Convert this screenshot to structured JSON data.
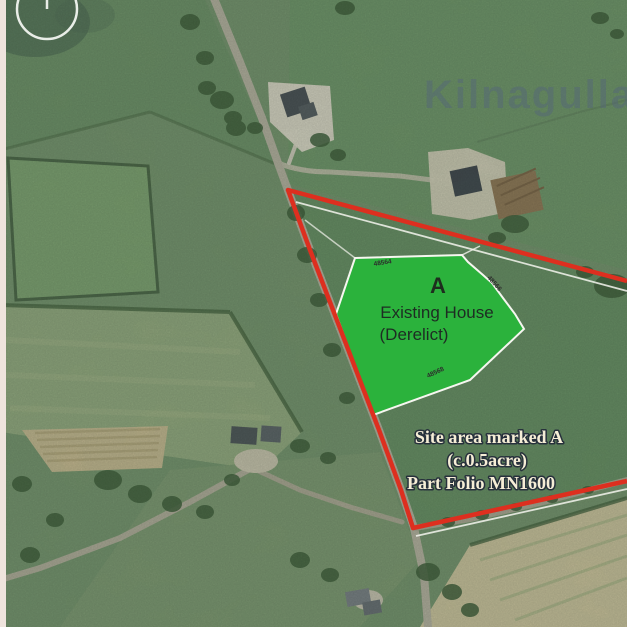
{
  "map": {
    "watermark_text": "Kilnagulla",
    "site": {
      "label": "A",
      "caption_line1": "Existing House",
      "caption_line2": "(Derelict)"
    },
    "note": {
      "line1": "Site area marked A",
      "line2": "(c.0.5acre)",
      "line3": "Part Folio MN1600"
    },
    "boundary_dimensions": {
      "top": "48564",
      "right": "48566",
      "bottom": "48568"
    },
    "colors": {
      "site_boundary_red": "#dd2f1f",
      "site_area_green": "#2bb23c",
      "note_text_cream": "#f6eed6",
      "watermark_blue_gray": "#53657c"
    }
  }
}
